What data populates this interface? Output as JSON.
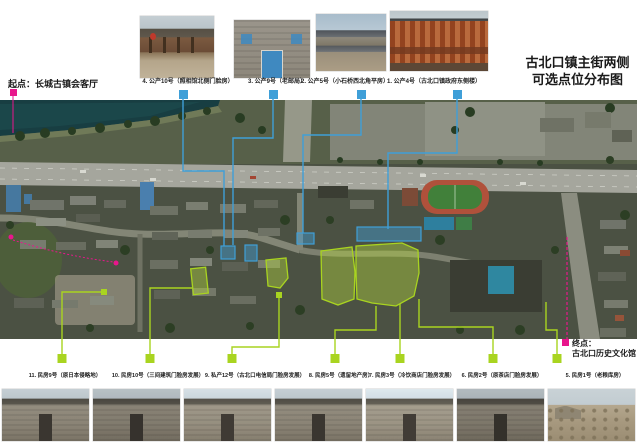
{
  "poster": {
    "title_line1": "古北口镇主街两侧",
    "title_line2": "可选点位分布图",
    "start_label": "起点：长城古镇会客厅",
    "end_label_line1": "终点：",
    "end_label_line2": "古北口历史文化馆"
  },
  "colors": {
    "callout_blue": "#3f9fd8",
    "callout_green": "#a9d420",
    "route_magenta": "#e8168c"
  },
  "top_photos": [
    {
      "caption": "4. 公产10号（照相馆北侧门脸房）"
    },
    {
      "caption": "3. 公产9号（老邮局）"
    },
    {
      "caption": "2. 公产5号（小石桥西北角平房）"
    },
    {
      "caption": "1. 公产4号（古北口镇政府东侧楼）"
    }
  ],
  "bottom_photos": [
    {
      "caption": "11. 民房9号（原日本侵略地）"
    },
    {
      "caption": "10. 民房10号（三间建筑门脸房发展）"
    },
    {
      "caption": "9. 私产12号（古北口电信局门脸房发展）"
    },
    {
      "caption": "8. 民房5号（遗留地产房）"
    },
    {
      "caption": "7. 民房3号（冷饮商店门脸房发展）"
    },
    {
      "caption": "6. 民房2号（原茶店门脸房发展）"
    },
    {
      "caption": "5. 民房1号（老粮库房）"
    }
  ]
}
